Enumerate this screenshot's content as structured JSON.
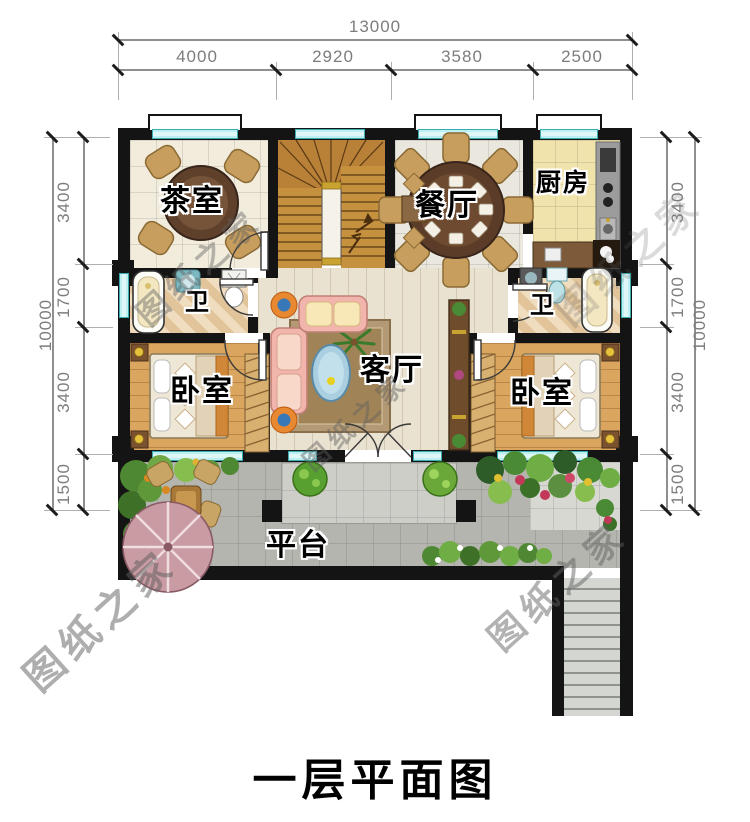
{
  "title": "一层平面图",
  "watermark": "图纸之家",
  "plan": {
    "dimensions": {
      "top": {
        "total": "13000",
        "segments": [
          "4000",
          "2920",
          "3580",
          "2500"
        ]
      },
      "left": {
        "total": "10000",
        "segments": [
          "3400",
          "1700",
          "3400",
          "1500"
        ]
      },
      "right": {
        "total": "10000",
        "segments": [
          "3400",
          "1700",
          "3400",
          "1500"
        ]
      }
    },
    "rooms": {
      "tea_room": "茶室",
      "dining": "餐厅",
      "kitchen": "厨房",
      "bath_left": "卫",
      "bath_right": "卫",
      "living": "客厅",
      "bedroom_left": "卧室",
      "bedroom_right": "卧室",
      "terrace": "平台"
    },
    "colors": {
      "wall": "#141414",
      "window": "#bdeef0",
      "tea_tile": "#f2ecdc",
      "dining_tile": "#eae7df",
      "kitchen_tile": "#f1e3ac",
      "bath_tile": "#ead6b4",
      "living_wood": "#e9e2d0",
      "bedroom_wood": "#d9a55f",
      "stair_wood": "#c6913f",
      "terrace_paving": "#b4b5af",
      "sofa": "#f2b5ad",
      "dimension_text": "#7d7d7d"
    }
  }
}
